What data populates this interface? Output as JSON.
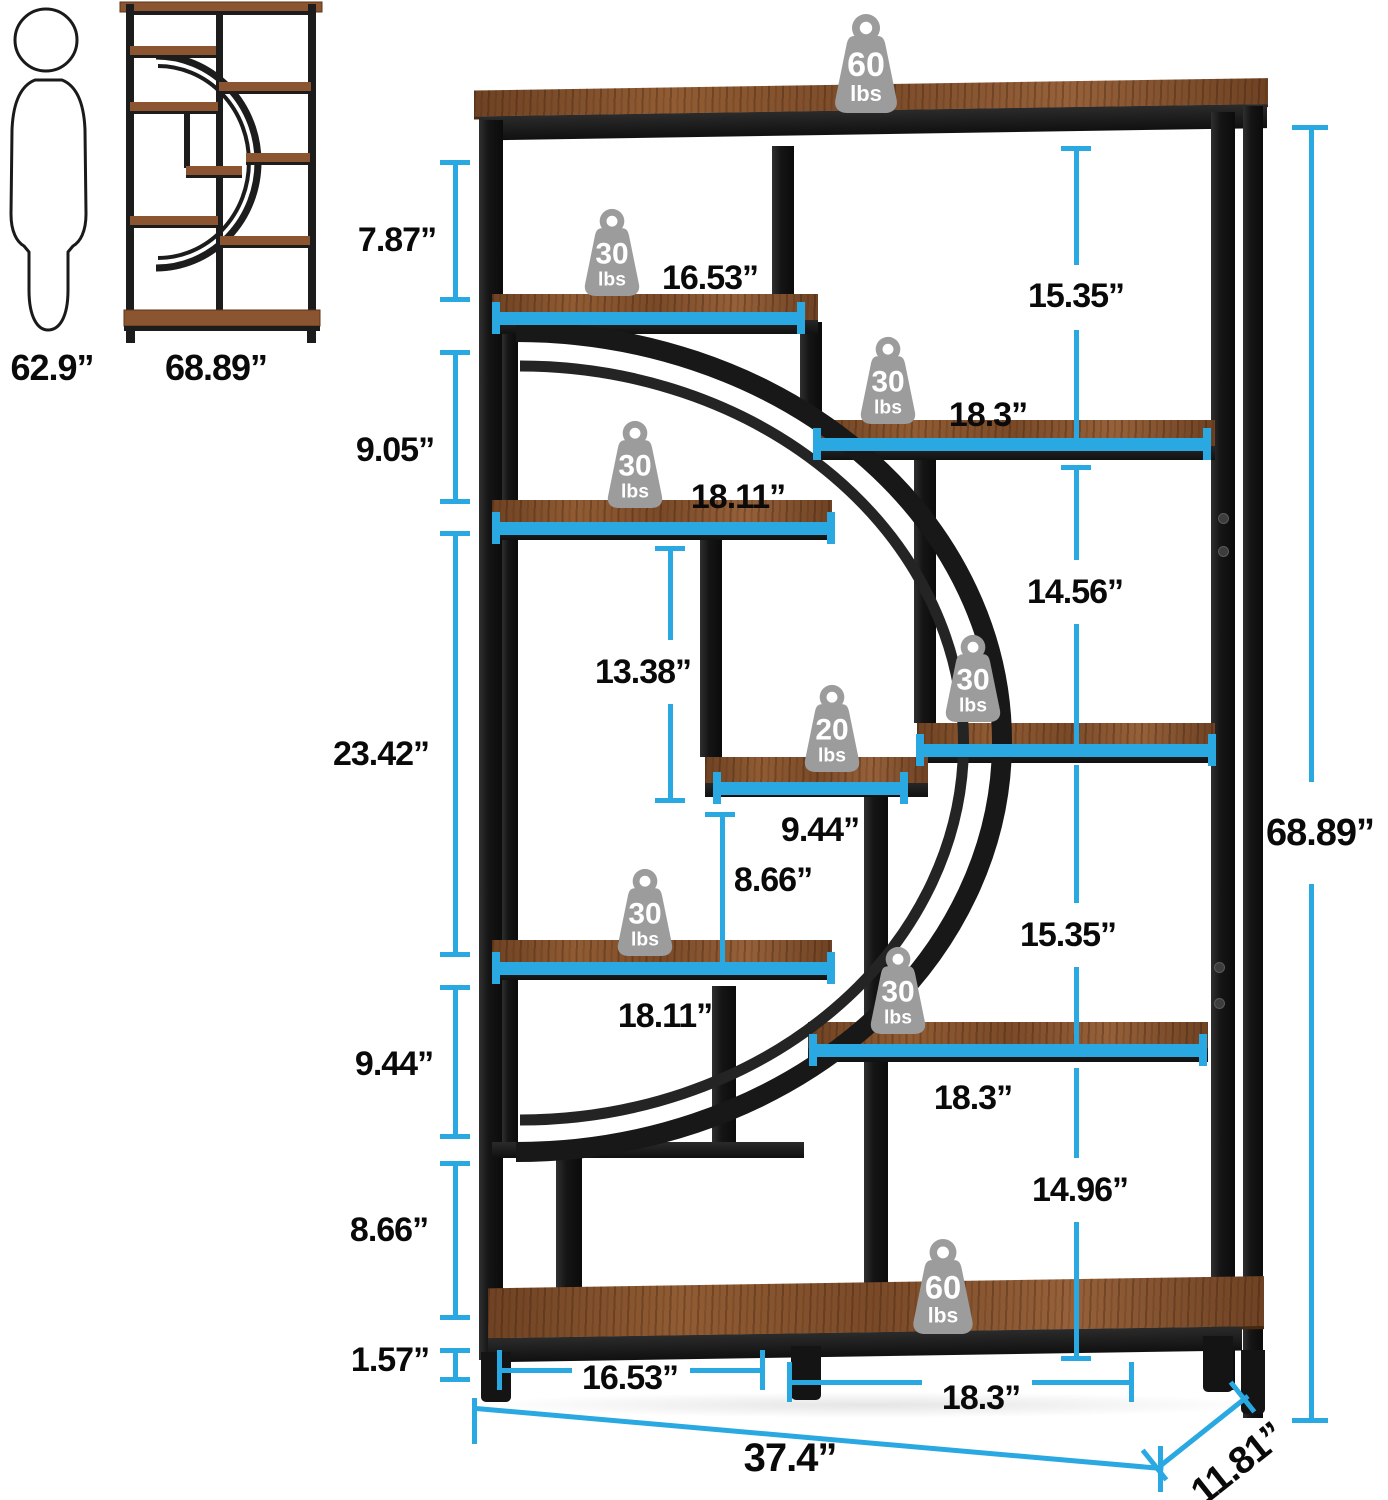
{
  "palette": {
    "accent": "#29A8E1",
    "frame": "#1b1b1b",
    "wood": "#8a5530",
    "weight_gray": "#9c9c9c"
  },
  "reference": {
    "person_height": "62.9”",
    "bookcase_height": "68.89”"
  },
  "dimensions": {
    "left": [
      "7.87”",
      "9.05”",
      "23.42”",
      "9.44”",
      "8.66”",
      "1.57”"
    ],
    "right": [
      "15.35”",
      "14.56”",
      "15.35”",
      "14.96”"
    ],
    "inner": [
      "16.53”",
      "18.3”",
      "18.11”",
      "13.38”",
      "9.44”",
      "8.66”",
      "18.11”",
      "18.3”"
    ],
    "bottom": [
      "16.53”",
      "18.3”"
    ],
    "overall_width": "37.4”",
    "overall_depth": "11.81”",
    "overall_height": "68.89”"
  },
  "weights": [
    {
      "value": "60",
      "unit": "lbs",
      "location": "top-surface"
    },
    {
      "value": "30",
      "unit": "lbs",
      "location": "upper-left-shelf"
    },
    {
      "value": "30",
      "unit": "lbs",
      "location": "upper-right-shelf"
    },
    {
      "value": "30",
      "unit": "lbs",
      "location": "second-left-shelf"
    },
    {
      "value": "30",
      "unit": "lbs",
      "location": "middle-right-shelf"
    },
    {
      "value": "20",
      "unit": "lbs",
      "location": "center-small-shelf"
    },
    {
      "value": "30",
      "unit": "lbs",
      "location": "lower-left-shelf"
    },
    {
      "value": "30",
      "unit": "lbs",
      "location": "lower-right-shelf"
    },
    {
      "value": "60",
      "unit": "lbs",
      "location": "bottom-shelf"
    }
  ]
}
